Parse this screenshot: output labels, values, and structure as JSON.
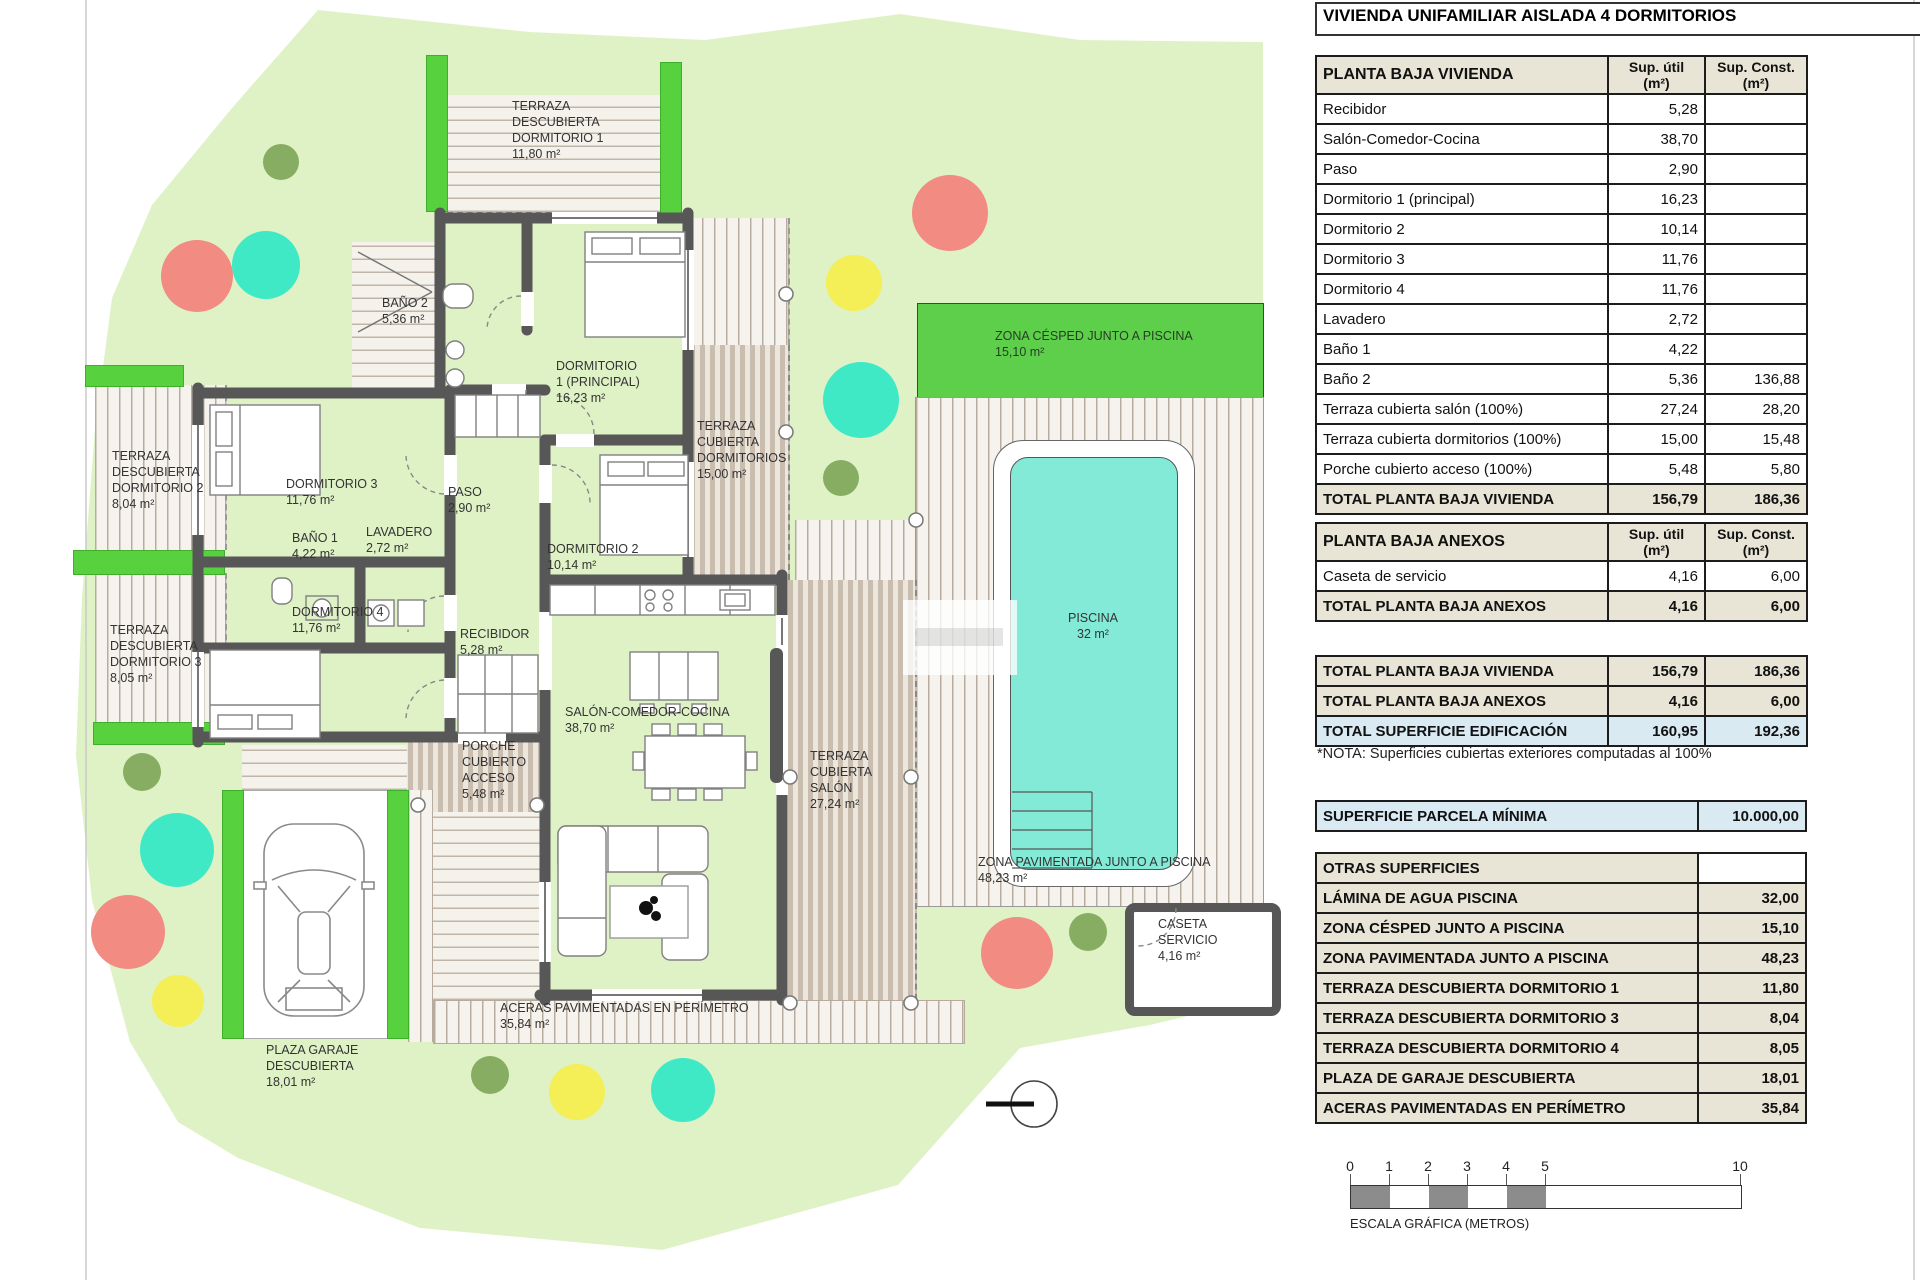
{
  "plan": {
    "labels": {
      "terraza_dorm1": "TERRAZA\nDESCUBIERTA\nDORMITORIO 1\n11,80 m²",
      "bano2": "BAÑO 2\n5,36 m²",
      "dorm1": "DORMITORIO\n1 (PRINCIPAL)\n16,23 m²",
      "terraza_cub_dorm": "TERRAZA\nCUBIERTA\nDORMITORIOS\n15,00 m²",
      "zona_cesped": "ZONA CÉSPED JUNTO A PISCINA\n15,10 m²",
      "terraza_dorm2": "TERRAZA\nDESCUBIERTA\nDORMITORIO 2\n8,04 m²",
      "dorm3": "DORMITORIO 3\n11,76 m²",
      "paso": "PASO\n2,90 m²",
      "bano1": "BAÑO 1\n4,22 m²",
      "lavadero": "LAVADERO\n2,72 m²",
      "dorm2": "DORMITORIO 2\n10,14 m²",
      "dorm4": "DORMITORIO 4\n11,76 m²",
      "recibidor": "RECIBIDOR\n5,28 m²",
      "terraza_dorm3": "TERRAZA\nDESCUBIERTA\nDORMITORIO 3\n8,05 m²",
      "salon": "SALÓN-COMEDOR-COCINA\n38,70 m²",
      "porche": "PORCHE\nCUBIERTO\nACCESO\n5,48 m²",
      "terraza_salon": "TERRAZA\nCUBIERTA\nSALÓN\n27,24 m²",
      "piscina": "PISCINA\n32 m²",
      "zona_pavimentada": "ZONA PAVIMENTADA JUNTO A PISCINA\n48,23 m²",
      "caseta": "CASETA\nSERVICIO\n4,16 m²",
      "aceras": "ACERAS PAVIMENTADAS EN PERÍMETRO\n35,84 m²",
      "plaza_garaje": "PLAZA GARAJE\nDESCUBIERTA\n18,01 m²"
    },
    "palette": {
      "parcel": "#dff2c6",
      "hedge": "#58d13f",
      "cesped_band": "#5ecf4a",
      "pool_water": "#82ead6",
      "wall": "#575757",
      "tree_salmon": "#f28b82",
      "tree_teal": "#3fe9c6",
      "tree_yellow": "#f4ee57",
      "tree_olive": "#86ad62",
      "table_beige": "#e8e4d6",
      "table_blue": "#d9eaf3"
    }
  },
  "panel": {
    "title": "VIVIENDA UNIFAMILIAR AISLADA 4 DORMITORIOS",
    "cols": {
      "util": "Sup. útil\n(m²)",
      "cons": "Sup. Const.\n(m²)"
    },
    "planta_baja": {
      "header": "PLANTA BAJA VIVIENDA",
      "rows": [
        {
          "label": "Recibidor",
          "util": "5,28",
          "cons": ""
        },
        {
          "label": "Salón-Comedor-Cocina",
          "util": "38,70",
          "cons": ""
        },
        {
          "label": "Paso",
          "util": "2,90",
          "cons": ""
        },
        {
          "label": "Dormitorio 1 (principal)",
          "util": "16,23",
          "cons": ""
        },
        {
          "label": "Dormitorio 2",
          "util": "10,14",
          "cons": ""
        },
        {
          "label": "Dormitorio 3",
          "util": "11,76",
          "cons": ""
        },
        {
          "label": "Dormitorio 4",
          "util": "11,76",
          "cons": ""
        },
        {
          "label": "Lavadero",
          "util": "2,72",
          "cons": ""
        },
        {
          "label": "Baño 1",
          "util": "4,22",
          "cons": ""
        },
        {
          "label": "Baño 2",
          "util": "5,36",
          "cons": "136,88"
        },
        {
          "label": "Terraza cubierta salón (100%)",
          "util": "27,24",
          "cons": "28,20"
        },
        {
          "label": "Terraza cubierta dormitorios (100%)",
          "util": "15,00",
          "cons": "15,48"
        },
        {
          "label": "Porche cubierto acceso (100%)",
          "util": "5,48",
          "cons": "5,80"
        }
      ],
      "total": {
        "label": "TOTAL PLANTA BAJA VIVIENDA",
        "util": "156,79",
        "cons": "186,36"
      }
    },
    "anexos": {
      "header": "PLANTA BAJA ANEXOS",
      "rows": [
        {
          "label": "Caseta de servicio",
          "util": "4,16",
          "cons": "6,00"
        }
      ],
      "total": {
        "label": "TOTAL PLANTA BAJA ANEXOS",
        "util": "4,16",
        "cons": "6,00"
      }
    },
    "resumen": [
      {
        "label": "TOTAL PLANTA BAJA VIVIENDA",
        "util": "156,79",
        "cons": "186,36"
      },
      {
        "label": "TOTAL PLANTA BAJA ANEXOS",
        "util": "4,16",
        "cons": "6,00"
      },
      {
        "label": "TOTAL SUPERFICIE EDIFICACIÓN",
        "util": "160,95",
        "cons": "192,36"
      }
    ],
    "nota": "*NOTA: Superficies cubiertas exteriores computadas al 100%",
    "parcela": {
      "label": "SUPERFICIE PARCELA MÍNIMA",
      "value": "10.000,00"
    },
    "otras": {
      "header": "OTRAS SUPERFICIES",
      "rows": [
        {
          "label": "LÁMINA DE AGUA PISCINA",
          "value": "32,00"
        },
        {
          "label": "ZONA CÉSPED JUNTO A PISCINA",
          "value": "15,10"
        },
        {
          "label": "ZONA PAVIMENTADA JUNTO A PISCINA",
          "value": "48,23"
        },
        {
          "label": "TERRAZA DESCUBIERTA DORMITORIO 1",
          "value": "11,80"
        },
        {
          "label": "TERRAZA DESCUBIERTA DORMITORIO 3",
          "value": "8,04"
        },
        {
          "label": "TERRAZA DESCUBIERTA DORMITORIO 4",
          "value": "8,05"
        },
        {
          "label": "PLAZA DE GARAJE DESCUBIERTA",
          "value": "18,01"
        },
        {
          "label": "ACERAS PAVIMENTADAS EN PERÍMETRO",
          "value": "35,84"
        }
      ]
    },
    "escala": {
      "ticks": [
        "0",
        "1",
        "2",
        "3",
        "4",
        "5",
        "10"
      ],
      "caption": "ESCALA GRÁFICA (METROS)"
    }
  }
}
